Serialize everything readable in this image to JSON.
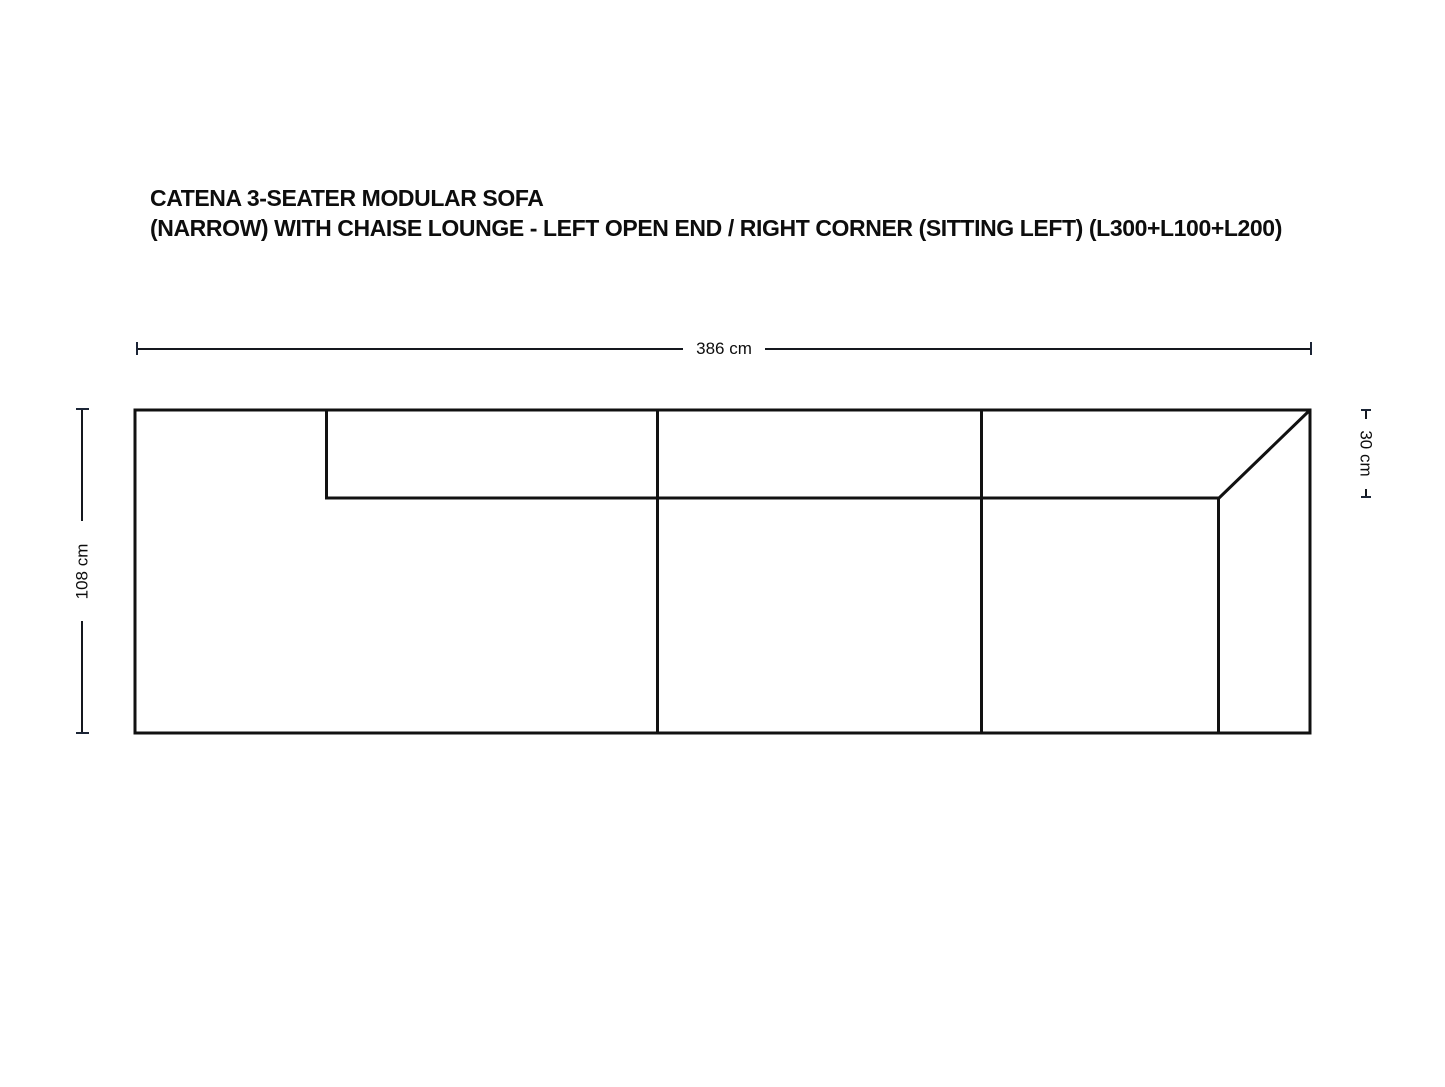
{
  "title": {
    "line1": "CATENA 3-SEATER MODULAR SOFA",
    "line2": "(NARROW) WITH CHAISE LOUNGE - LEFT OPEN END / RIGHT CORNER (SITTING LEFT) (L300+L100+L200)"
  },
  "dimensions": {
    "overall_width": "386 cm",
    "overall_depth": "108 cm",
    "backrest_depth": "30 cm"
  },
  "colors": {
    "line": "#111111",
    "text": "#0d0d0d",
    "background": "#ffffff"
  }
}
